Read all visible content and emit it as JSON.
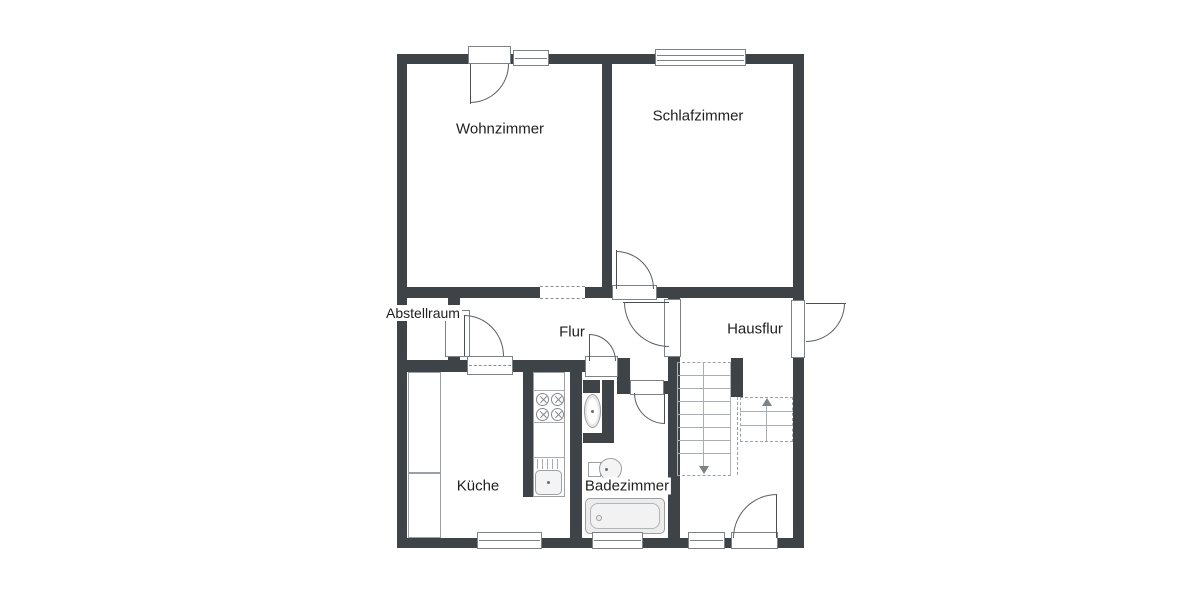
{
  "floorplan": {
    "rooms": [
      {
        "id": "wohnzimmer",
        "label": "Wohnzimmer"
      },
      {
        "id": "schlafzimmer",
        "label": "Schlafzimmer"
      },
      {
        "id": "abstellraum",
        "label": "Abstellraum"
      },
      {
        "id": "flur",
        "label": "Flur"
      },
      {
        "id": "hausflur",
        "label": "Hausflur"
      },
      {
        "id": "kueche",
        "label": "Küche"
      },
      {
        "id": "badezimmer",
        "label": "Badezimmer"
      }
    ],
    "fixtures": [
      "staircase",
      "stove",
      "kitchen-sink",
      "cupboards",
      "toilet",
      "washbasin",
      "bathtub"
    ],
    "colors": {
      "wall": "#3e4347",
      "line": "#9aa0a5",
      "background": "#ffffff",
      "text": "#1f1f1f"
    }
  }
}
